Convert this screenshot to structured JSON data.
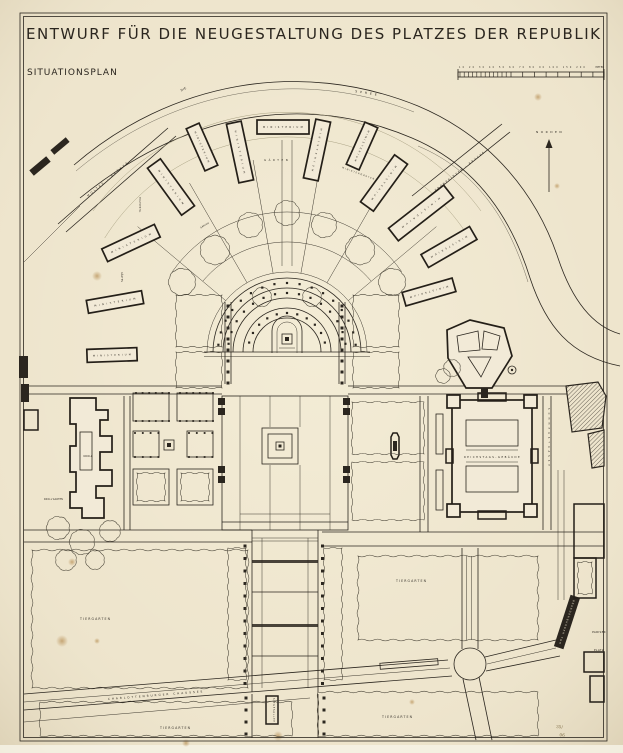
{
  "sheet": {
    "title": "ENTWURF FÜR DIE NEUGESTALTUNG DES PLATZES DER REPUBLIK",
    "subtitle": "SITUATIONSPLAN",
    "north_label": "NORDEN",
    "scale": {
      "numbers": "10 20 30 40 50 60 70 80 90 100 150 200",
      "unit": "METER"
    },
    "inventory_mark": {
      "line1": "35/",
      "line2": "06"
    },
    "colors": {
      "paper": "#eee5cd",
      "ink": "#2b261f",
      "foxing": "#a5732d"
    }
  },
  "map": {
    "river": {
      "word1": "DIE",
      "word2": "SPREE"
    },
    "bridges": {
      "moltke": "MOLTKE - BRÜCKE",
      "kronprinzen": "KRONPRINZEN - BRÜCKE"
    },
    "streets": {
      "moltkestrasse": "MOLTKESTR.",
      "sommerstrasse": "SOMMERSTRASSE",
      "charlottenburger_chaussee": "CHARLOTTENBURGER CHAUSSEE",
      "siegesallee": "SIEGESALLEE"
    },
    "buildings": {
      "ministerium": "MINISTERIUM",
      "reichstag": "REICHSTAGS-GEBÄUDE",
      "kroll": "KROLL",
      "brandenburger_tor": "BRANDENBURGER TOR"
    },
    "areas": {
      "gaerten": "GÄRTEN",
      "minister_gaerten": "MINISTERGÄRTEN",
      "tiergarten": "TIERGARTEN",
      "kroll_garten": "KROLL'GARTEN",
      "pariser": "PARISER",
      "platz": "PLATZ"
    }
  }
}
